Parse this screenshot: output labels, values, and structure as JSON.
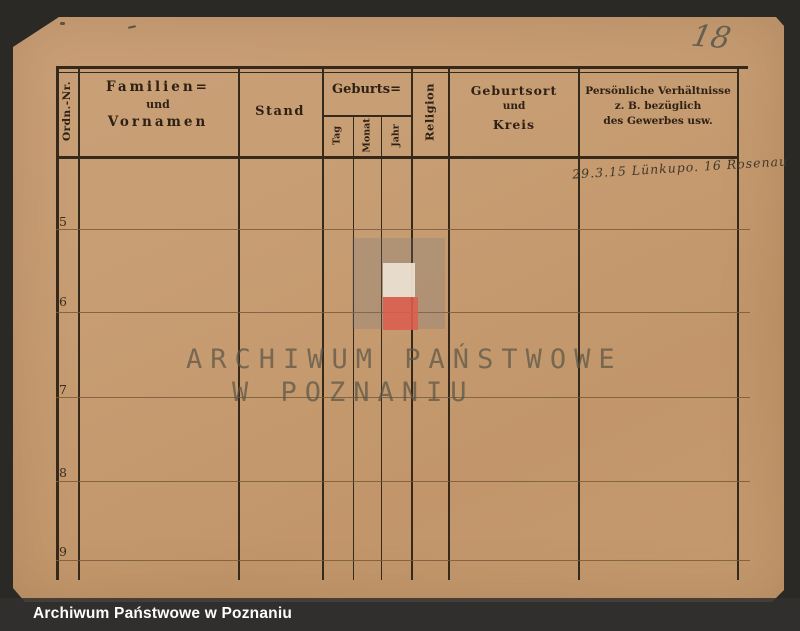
{
  "header": {
    "ordn": "Ordn.-Nr.",
    "name_line1": "Familien=",
    "name_line2": "und",
    "name_line3": "Vornamen",
    "stand": "Stand",
    "geburts": "Geburts=",
    "tag": "Tag",
    "monat": "Monat",
    "jahr": "Jahr",
    "religion": "Religion",
    "ort_line1": "Geburtsort",
    "ort_line2": "und",
    "ort_line3": "Kreis",
    "pers_line1": "Persönliche Verhältnisse",
    "pers_line2": "z. B. bezüglich",
    "pers_line3": "des Gewerbes usw."
  },
  "rows": [
    "5",
    "6",
    "7",
    "8",
    "9"
  ],
  "annotations": {
    "page_number": "18",
    "note": "29.3.15 Lünkupo. 16 Rosenau"
  },
  "watermark": {
    "line1": "ARCHIWUM PAŃSTWOWE",
    "line2": "W POZNANIU"
  },
  "caption": {
    "text": "Archiwum Państwowe w Poznaniu"
  },
  "colors": {
    "paper": "#c79d73",
    "table_line": "#35291b",
    "row_line": "#7a5a38",
    "patch_white": "#eadfd0",
    "patch_red": "#df5c4e",
    "caption_bg": "#4c4b49",
    "caption_text": "#ffffff"
  }
}
